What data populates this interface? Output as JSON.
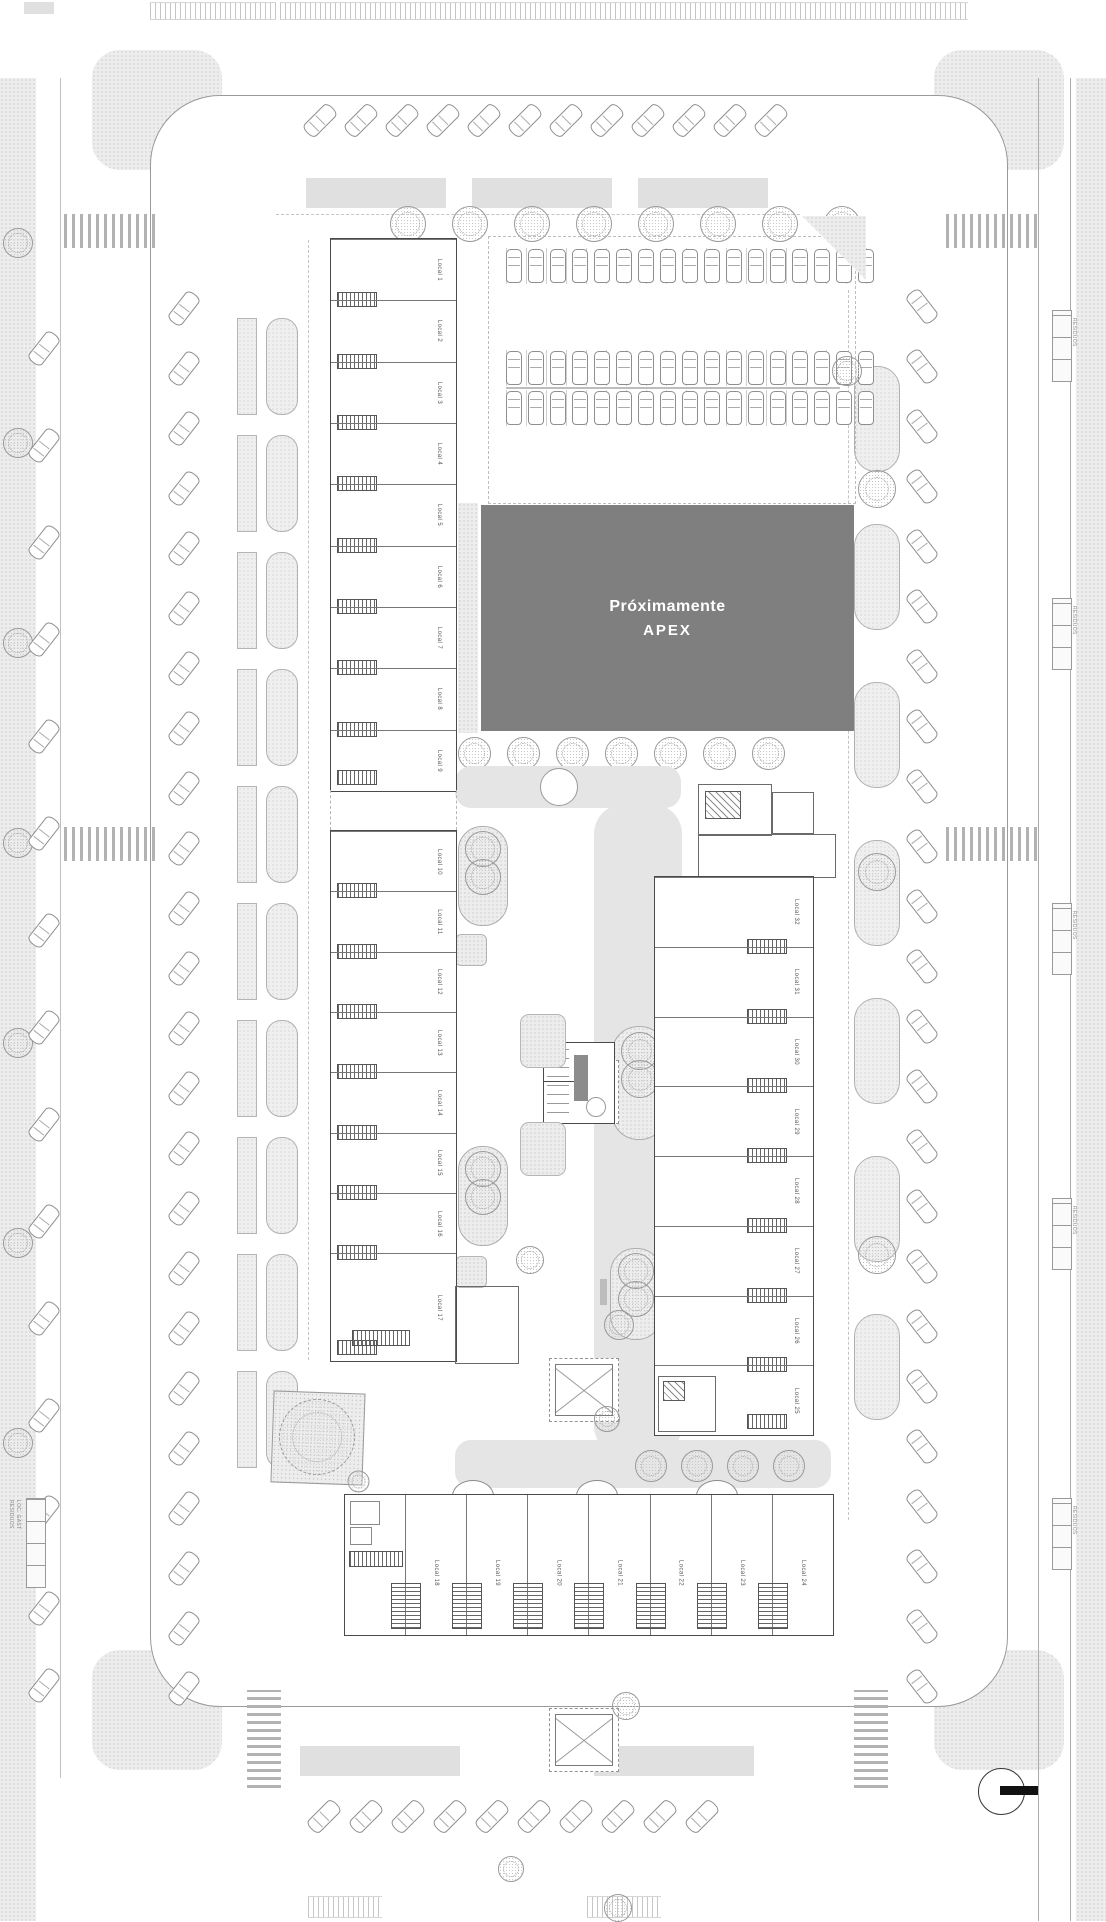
{
  "sign": {
    "line1": "Próximamente",
    "line2": "APEX"
  },
  "buildings": {
    "left_top": [
      "Local 1",
      "Local 2",
      "Local 3",
      "Local 4",
      "Local 5",
      "Local 6",
      "Local 7",
      "Local 8",
      "Local 9"
    ],
    "left_bottom": [
      "Local 10",
      "Local 11",
      "Local 12",
      "Local 13",
      "Local 14",
      "Local 15",
      "Local 16",
      "Local 17"
    ],
    "right_column": [
      "Local 32",
      "Local 31",
      "Local 30",
      "Local 29",
      "Local 28",
      "Local 27",
      "Local 26",
      "Local 25"
    ],
    "bottom_row": [
      "Local 18",
      "Local 19",
      "Local 20",
      "Local 21",
      "Local 22",
      "Local 23",
      "Local 24"
    ]
  },
  "waste": {
    "label": "RESIDUOS",
    "left_sub": "LOC. GAST"
  },
  "colors": {
    "apex_bg": "#7f7f7f",
    "apex_text": "#ffffff",
    "plaza": "#e5e5e5",
    "drawing_line": "#9a9a9a"
  }
}
